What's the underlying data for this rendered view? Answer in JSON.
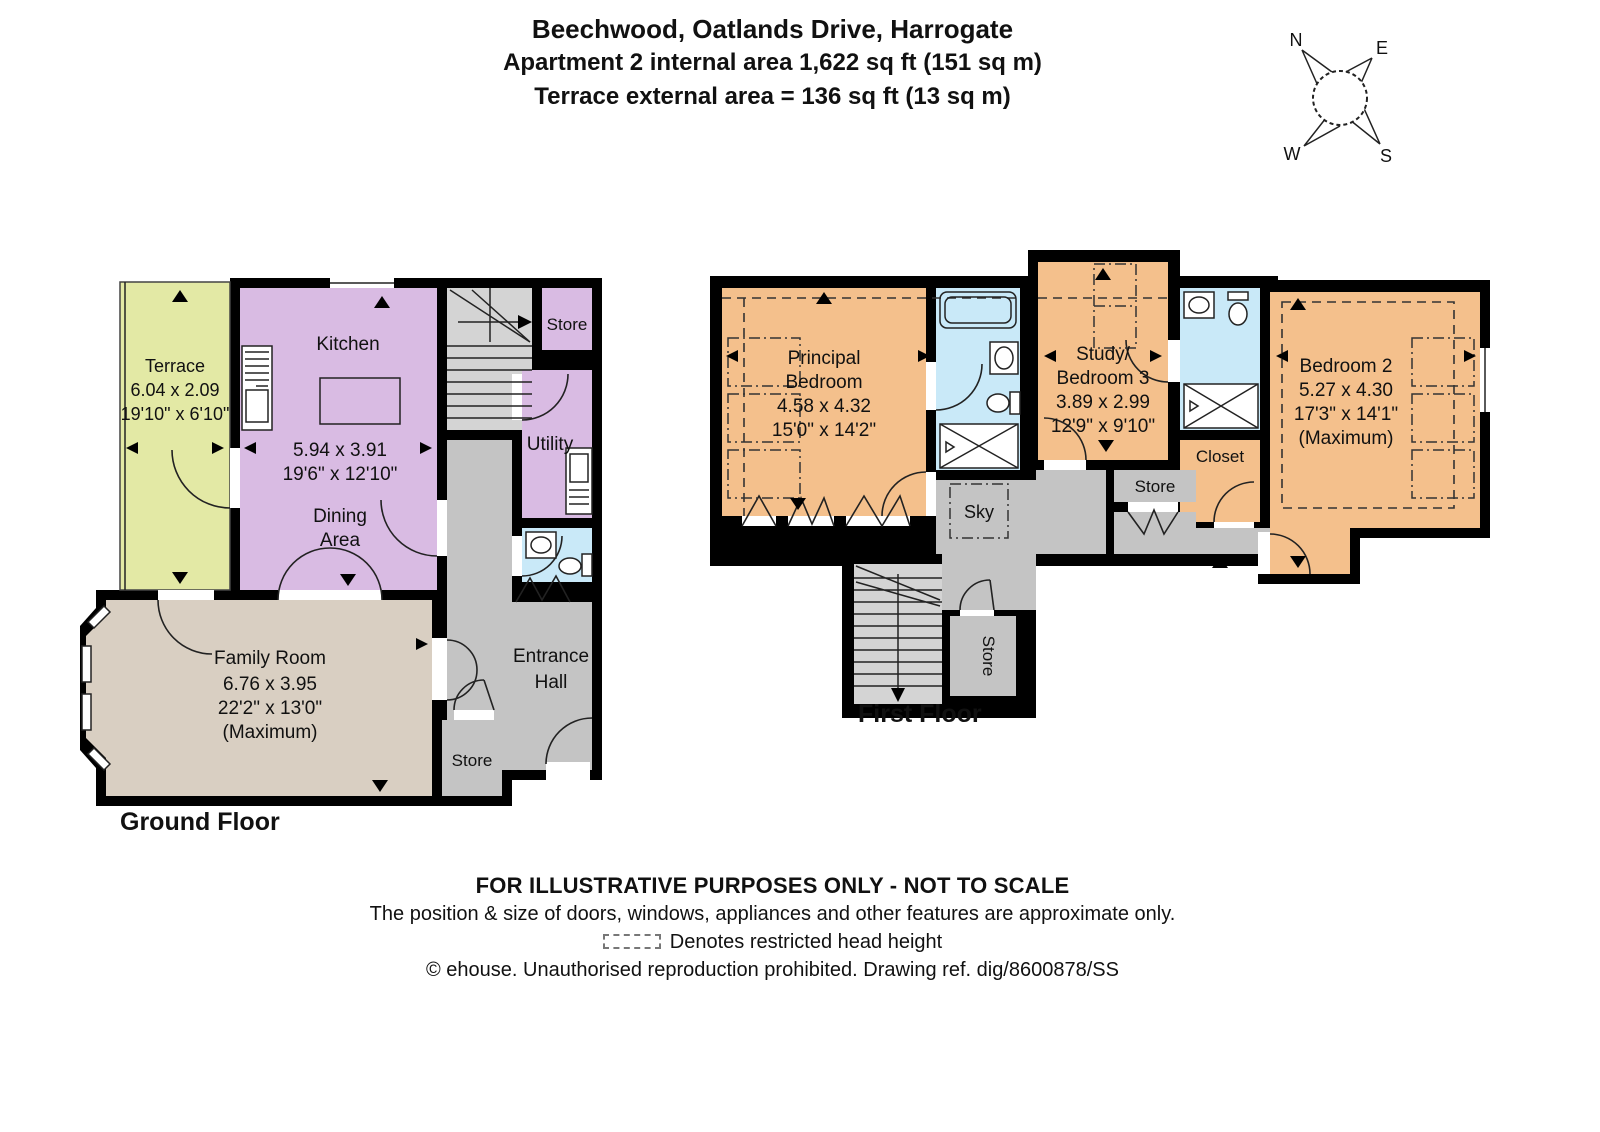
{
  "title": {
    "line1": "Beechwood, Oatlands Drive, Harrogate",
    "line2": "Apartment 2 internal area 1,622 sq ft (151 sq m)",
    "line3": "Terrace external area = 136 sq ft (13 sq m)"
  },
  "compass": {
    "north": "N",
    "east": "E",
    "south": "S",
    "west": "W"
  },
  "ground_floor": {
    "label": "Ground Floor",
    "terrace": [
      "Terrace",
      "6.04 x 2.09",
      "19'10\" x 6'10\""
    ],
    "kitchen_name": "Kitchen",
    "kitchen_dims": [
      "5.94 x 3.91",
      "19'6\" x 12'10\""
    ],
    "dining": [
      "Dining",
      "Area"
    ],
    "store_top": "Store",
    "utility": "Utility",
    "family": [
      "Family Room",
      "6.76 x 3.95",
      "22'2\" x 13'0\"",
      "(Maximum)"
    ],
    "hall": [
      "Entrance",
      "Hall"
    ],
    "store_bottom": "Store"
  },
  "first_floor": {
    "label": "First Floor",
    "principal": [
      "Principal",
      "Bedroom",
      "4.58 x 4.32",
      "15'0\" x 14'2\""
    ],
    "study": [
      "Study/",
      "Bedroom 3",
      "3.89 x 2.99",
      "12'9\" x 9'10\""
    ],
    "bedroom2": [
      "Bedroom 2",
      "5.27 x 4.30",
      "17'3\" x 14'1\"",
      "(Maximum)"
    ],
    "closet": "Closet",
    "store_mid": "Store",
    "sky": "Sky",
    "store_stair": "Store"
  },
  "footer": {
    "line1": "FOR ILLUSTRATIVE PURPOSES ONLY - NOT TO SCALE",
    "line2": "The position & size of doors, windows, appliances and other features are approximate only.",
    "line3": "Denotes restricted head height",
    "line4": "© ehouse. Unauthorised reproduction prohibited. Drawing ref. dig/8600878/SS"
  },
  "colors": {
    "wall": "#000000",
    "terrace": "#e3e9a5",
    "kitchen": "#d9bbe3",
    "family": "#d9cfc2",
    "hall": "#c4c4c4",
    "stairs": "#d4d4d4",
    "bedroom": "#f4c08c",
    "bath": "#c9e9f8"
  }
}
